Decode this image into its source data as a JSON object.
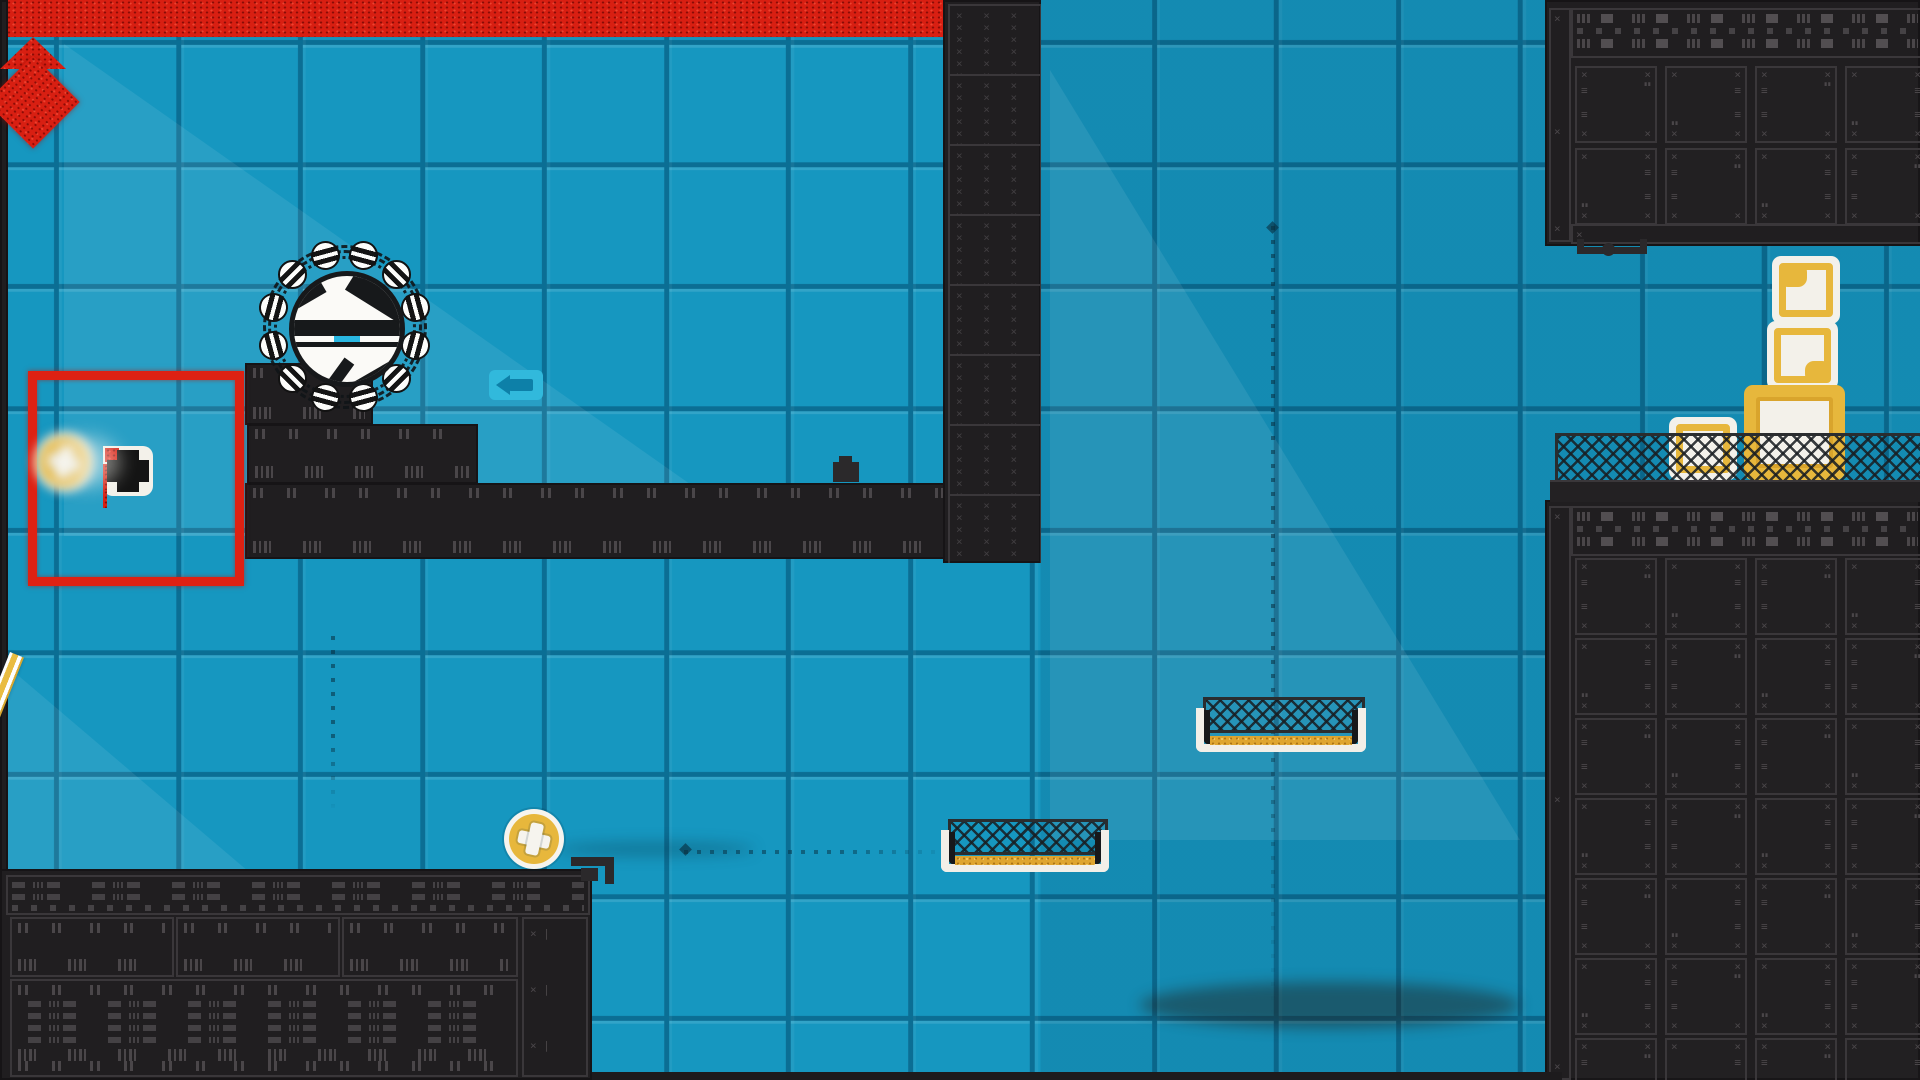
{
  "meta": {
    "app": "2d-platformer-game-scene",
    "hud_text": "none-visible"
  },
  "scene": {
    "size": {
      "w": 1920,
      "h": 1080
    },
    "colors": {
      "tile_blue": "#1697c0",
      "tile_gap": "#0b6e94",
      "tile_highlight": "#2ab5dc",
      "structure_dark": "#201e20",
      "structure_outline": "#3a373a",
      "structure_marks": "#4a4649",
      "hazard_red": "#d81f12",
      "gold": "#e7b73c",
      "crate_white": "#f3f1ea",
      "accent_cyan": "#29b7e2",
      "mesh_dark": "#2a2d2f"
    },
    "blocks": [
      {
        "name": "left-screen-edge",
        "x": 0,
        "y": 0,
        "w": 8,
        "h": 1080,
        "kind": "plain"
      },
      {
        "name": "step-platform-small",
        "x": 245,
        "y": 363,
        "w": 128,
        "h": 62,
        "kind": "steps"
      },
      {
        "name": "step-platform-mid",
        "x": 247,
        "y": 424,
        "w": 231,
        "h": 60,
        "kind": "steps"
      },
      {
        "name": "long-platform",
        "x": 245,
        "y": 483,
        "w": 796,
        "h": 76,
        "kind": "steps"
      },
      {
        "name": "wall-column",
        "x": 943,
        "y": 0,
        "w": 98,
        "h": 563,
        "kind": "xcol",
        "panels": 8
      },
      {
        "name": "top-right-structure",
        "x": 1545,
        "y": 0,
        "w": 375,
        "h": 246,
        "kind": "complex",
        "grid": {
          "ox": 30,
          "oy": 66,
          "cols": 5,
          "rows": 2,
          "pw": 78,
          "ph": 73,
          "gx": 12,
          "gy": 9
        },
        "band": {
          "x": 26,
          "y": 8,
          "w": 349,
          "h": 46
        },
        "strips": [
          {
            "x": 4,
            "y": 8,
            "w": 18,
            "h": 230
          },
          {
            "x": 26,
            "y": 224,
            "w": 349,
            "h": 16
          }
        ]
      },
      {
        "name": "right-structure",
        "x": 1545,
        "y": 500,
        "w": 375,
        "h": 580,
        "kind": "complex",
        "grid": {
          "ox": 30,
          "oy": 58,
          "cols": 5,
          "rows": 7,
          "pw": 78,
          "ph": 73,
          "gx": 12,
          "gy": 7
        },
        "band": {
          "x": 26,
          "y": 6,
          "w": 349,
          "h": 46
        },
        "strips": [
          {
            "x": 4,
            "y": 6,
            "w": 18,
            "h": 570
          }
        ]
      },
      {
        "name": "bottom-left-structure",
        "x": 0,
        "y": 869,
        "w": 592,
        "h": 211,
        "kind": "bleft"
      }
    ],
    "fence_ledge": {
      "name": "fence-ledge",
      "mesh": {
        "x": 1555,
        "y": 433,
        "w": 365,
        "h": 49
      },
      "bar": {
        "x": 1550,
        "y": 480,
        "w": 370,
        "h": 22
      }
    },
    "lava": {
      "name": "lava-floor",
      "x": 592,
      "y": 1038,
      "w": 970,
      "h": 37,
      "base": {
        "y": 1072,
        "h": 8
      },
      "spike": {
        "cx": 822,
        "apexY": 1008,
        "halfW": 33,
        "h": 32
      }
    },
    "red_frame": {
      "name": "red-target-frame",
      "x": 28,
      "y": 371,
      "w": 198,
      "h": 197,
      "border": 9
    },
    "diamond_hazard": {
      "name": "red-diamond-hazard",
      "cx": 333,
      "cy": 670,
      "size": 66
    },
    "gadget": {
      "name": "switch-gadget",
      "x": 103,
      "y": 446,
      "w": 50,
      "h": 50
    },
    "coins": [
      {
        "name": "coin-token-blurred",
        "cx": 64,
        "cy": 462,
        "r": 30,
        "blur": true
      },
      {
        "name": "coin-token",
        "cx": 534,
        "cy": 839,
        "r": 30,
        "blur": false
      }
    ],
    "baskets": [
      {
        "name": "mesh-basket-low",
        "x": 941,
        "y": 819,
        "w": 168,
        "h": 53
      },
      {
        "name": "mesh-basket-high",
        "x": 1196,
        "y": 697,
        "w": 170,
        "h": 55
      }
    ],
    "crates": [
      {
        "name": "crate-top",
        "x": 1772,
        "y": 256,
        "w": 68,
        "h": 68,
        "style": "white",
        "patch": "tl"
      },
      {
        "name": "crate-middle",
        "x": 1767,
        "y": 321,
        "w": 71,
        "h": 69,
        "style": "white",
        "patch": "br"
      },
      {
        "name": "crate-big-gold",
        "x": 1744,
        "y": 385,
        "w": 101,
        "h": 95,
        "style": "gold"
      },
      {
        "name": "crate-small-left",
        "x": 1669,
        "y": 417,
        "w": 68,
        "h": 63,
        "style": "white",
        "patch": "none"
      }
    ],
    "beam": {
      "name": "gold-pole",
      "x": 10,
      "y": 652,
      "len": 236,
      "w": 15,
      "angleDeg": 21.8
    },
    "arrow_sign": {
      "name": "arrow-left-sign",
      "x": 489,
      "y": 370,
      "w": 54,
      "h": 30
    },
    "character": {
      "name": "spike-ball-character",
      "cx": 342,
      "cy": 324,
      "ringR": 74,
      "balls": 12
    },
    "paths": [
      {
        "name": "guide-path-vertical-main",
        "type": "v",
        "x": 1271,
        "y1": 226,
        "y2": 1032,
        "diamond": [
          1271,
          226
        ]
      },
      {
        "name": "guide-path-vertical-diamond",
        "type": "v",
        "x": 331,
        "y1": 636,
        "y2": 816,
        "diamond": null
      },
      {
        "name": "guide-path-horizontal",
        "type": "h",
        "y": 850,
        "x1": 684,
        "x2": 962,
        "diamond": [
          684,
          848
        ]
      }
    ],
    "connectors": [
      {
        "name": "hanging-bracket",
        "parts": [
          [
            1577,
            247,
            70,
            7
          ],
          [
            1577,
            239,
            7,
            9
          ],
          [
            1640,
            239,
            7,
            9
          ],
          [
            1602,
            243,
            13,
            13
          ]
        ]
      },
      {
        "name": "pipe-bracket-platform",
        "parts": [
          [
            571,
            857,
            42,
            9
          ],
          [
            605,
            857,
            9,
            27
          ],
          [
            581,
            868,
            17,
            13
          ]
        ]
      },
      {
        "name": "platform-stub",
        "parts": [
          [
            833,
            462,
            26,
            20
          ],
          [
            839,
            456,
            13,
            7
          ]
        ]
      }
    ],
    "sheens": [
      {
        "x": 64,
        "y": 44,
        "w": 700,
        "h": 492,
        "shape": "tri-left"
      },
      {
        "x": 1050,
        "y": 70,
        "w": 470,
        "h": 770,
        "shape": "tri-left"
      },
      {
        "x": 0,
        "y": 660,
        "w": 470,
        "h": 400,
        "shape": "tri-left"
      }
    ],
    "smudges": [
      {
        "x": 1140,
        "y": 982,
        "w": 380,
        "h": 46,
        "color": "rgba(35,18,8,.4)"
      },
      {
        "x": 555,
        "y": 842,
        "w": 200,
        "h": 14,
        "color": "rgba(8,40,55,.28)"
      }
    ]
  }
}
